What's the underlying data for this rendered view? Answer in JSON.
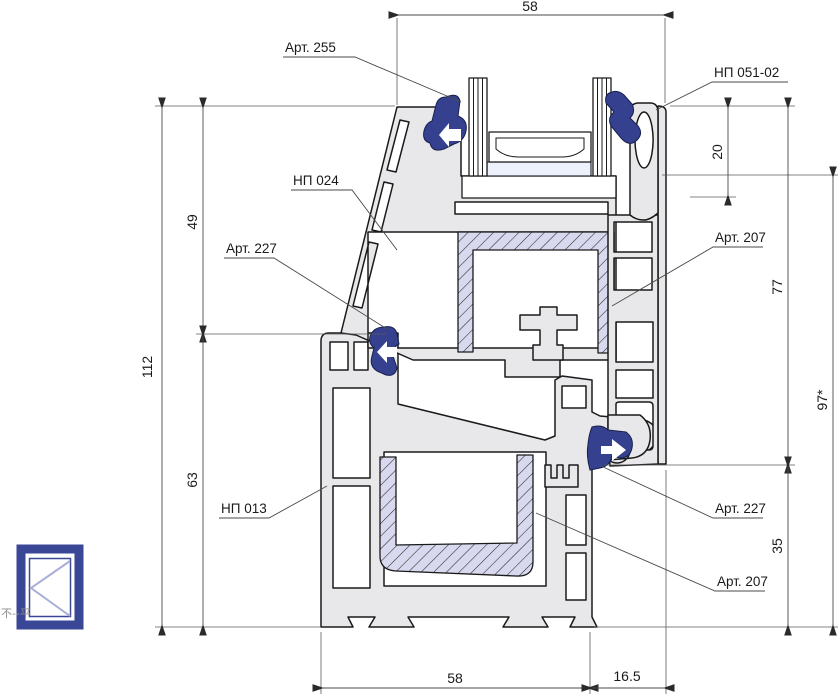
{
  "drawing": {
    "type": "window-profile-cross-section",
    "dims": {
      "top_width": "58",
      "left_total": "112",
      "left_upper": "49",
      "left_lower": "63",
      "bead_height": "20",
      "right_upper": "77",
      "right_lower": "35",
      "right_total": "97*",
      "bottom_width": "58",
      "bottom_offset": "16.5"
    },
    "part_labels": {
      "gasket_glazing": "Арт. 255",
      "glazing_bead": "НП 051-02",
      "sash_profile": "НП 024",
      "gasket_sash_left": "Арт. 227",
      "steel_sash": "Арт. 207",
      "frame_profile": "НП 013",
      "gasket_frame_right": "Арт. 227",
      "steel_frame": "Арт. 207"
    },
    "icon_watermark": "不--平",
    "colors": {
      "profile_fill": "#e8e8ea",
      "outline": "#1a1a1a",
      "steel_fill": "#d8d8ef",
      "gasket_blue": "#35418f",
      "icon_blue": "#3a4696",
      "dim_line": "#4a4a4a"
    }
  }
}
